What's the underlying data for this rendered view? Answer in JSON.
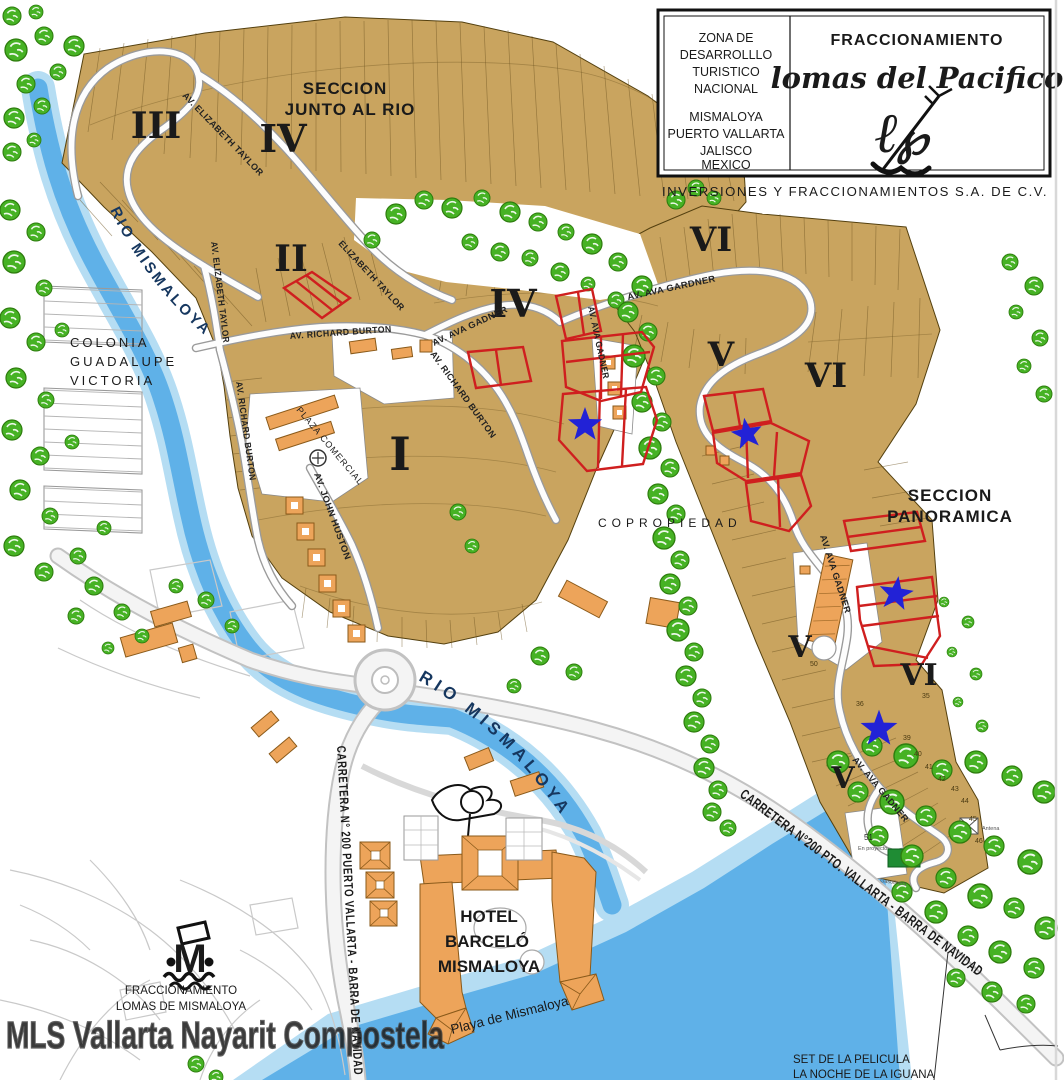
{
  "title_block": {
    "zone_lines": [
      "ZONA DE",
      "DESARROLLLO",
      "TURISTICO",
      "NACIONAL"
    ],
    "place_lines": [
      "MISMALOYA",
      "PUERTO VALLARTA",
      "JALISCO",
      "MEXICO"
    ],
    "heading": "FRACCIONAMIENTO",
    "name_script": "lomas del Pacifico",
    "company": "INVERSIONES Y FRACCIONAMIENTOS S.A. DE C.V."
  },
  "section_titles": {
    "junto1": "SECCION",
    "junto2": "JUNTO AL RIO",
    "pan1": "SECCION",
    "pan2": "PANORAMICA"
  },
  "numerals": {
    "iii": "III",
    "iv_top": "IV",
    "ii": "II",
    "iv_mid": "IV",
    "i": "I",
    "vi_top": "VI",
    "v_mid": "V",
    "vi_mid": "VI",
    "v_right": "V",
    "vi_right": "VI",
    "v_low": "V"
  },
  "streets": {
    "elizabeth_a": "AV. ELIZABETH TAYLOR",
    "elizabeth_b": "AV. ELIZABETH TAYLOR",
    "elizabeth_c": "ELIZABETH TAYLOR",
    "burton_a": "AV. RICHARD BURTON",
    "burton_b": "AV. RICHARD BURTON",
    "burton_c": "AV. RICHARD BURTON",
    "ava_a": "AV. AVA GARDNER",
    "ava_b": "AV. AVA GADNER",
    "ava_c": "AV. AVA GADNER",
    "ava_d": "AV. AVA GADNER",
    "ava_e": "AV. AVA GADNER",
    "john_huston": "AV. JOHN HUSTON"
  },
  "highways": {
    "left": "CARRETERA N° 200 PUERTO VALLARTA - BARRA DE NAVIDAD",
    "right": "CARRETERA N°200 PTO. VALLARTA - BARRA DE NAVIDAD"
  },
  "water": {
    "river_upper": "RIO MISMALOYA",
    "river_lower": "RIO MISMALOYA"
  },
  "places": {
    "colonia_1": "COLONIA",
    "colonia_2": "GUADALUPE",
    "colonia_3": "VICTORIA",
    "copropiedad": "COPROPIEDAD",
    "hotel_1": "HOTEL",
    "hotel_2": "BARCELÓ",
    "hotel_3": "MISMALOYA",
    "playa": "Playa de Mismaloya",
    "frac_1": "FRACCIONAMIENTO",
    "frac_2": "LOMAS DE MISMALOYA",
    "plaza": "PLAZA COMERCIAL",
    "set_1": "SET DE LA PELICULA",
    "set_2": "LA NOCHE DE LA IGUANA"
  },
  "lots": {
    "v_right_num": "50",
    "vi_right_num": "35",
    "strip_numbers": [
      "36",
      "39",
      "40",
      "41",
      "42",
      "43",
      "44",
      "45",
      "46"
    ],
    "n51": "51",
    "n51_sub": "En proyecto",
    "gasolinera": "Gasolinera",
    "antena": "Antena"
  },
  "watermark": "MLS Vallarta Nayarit Compostela",
  "legend": {
    "highlight_red": "#cf1f1f",
    "star_blue": "#2222d6",
    "lot_tan": "#c9a45f",
    "forest_green": "#46b224",
    "river_blue": "#5fb1e8",
    "building_orange": "#eda45a"
  }
}
